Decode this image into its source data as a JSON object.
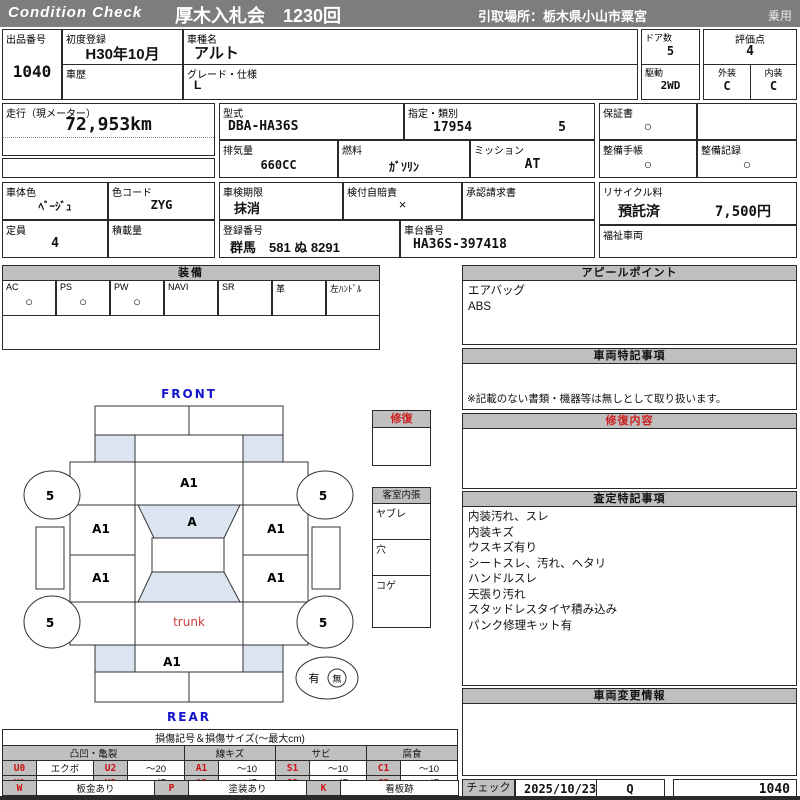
{
  "colors": {
    "header_gray": "#7d7d7d",
    "panel_gray": "#bfbfbf",
    "accent_red": "#cc2020",
    "label_blue": "#1414cc",
    "trunk_red": "#cc4040",
    "shade_blue": "#dbe4f0"
  },
  "header": {
    "brand": "Condition  Check",
    "auction_title": "厚木入札会　1230回",
    "pickup": "引取場所：栃木県小山市粟宮",
    "category": "乗用"
  },
  "fields": {
    "lot": {
      "label": "出品番号",
      "value": "1040"
    },
    "first_reg": {
      "label": "初度登録",
      "value": "H30年10月"
    },
    "history": {
      "label": "車歴",
      "value": ""
    },
    "model": {
      "label": "車種名",
      "value": "アルト"
    },
    "grade": {
      "label": "グレード・仕様",
      "value": "L"
    },
    "doors": {
      "label": "ドア数",
      "value": "5"
    },
    "drive": {
      "label": "駆動",
      "value": "2WD"
    },
    "score": {
      "label": "評価点",
      "value": "4"
    },
    "exterior": {
      "label": "外装",
      "value": "C"
    },
    "interior": {
      "label": "内装",
      "value": "C"
    },
    "mileage": {
      "label": "走行（現メーター）",
      "value": "72,953km"
    },
    "model_code": {
      "label": "型式",
      "value": "DBA-HA36S"
    },
    "type_class": {
      "label": "指定・類別",
      "value1": "17954",
      "value2": "5"
    },
    "displacement": {
      "label": "排気量",
      "value": "660CC"
    },
    "fuel": {
      "label": "燃料",
      "value": "ｶﾞｿﾘﾝ"
    },
    "transmission": {
      "label": "ミッション",
      "value": "AT"
    },
    "warranty": {
      "label": "保証書",
      "value": "○"
    },
    "service_book": {
      "label": "整備手帳",
      "value": "○"
    },
    "service_record": {
      "label": "整備記録",
      "value": "○"
    },
    "body_color": {
      "label": "車体色",
      "value": "ﾍﾞｰｼﾞｭ"
    },
    "color_code": {
      "label": "色コード",
      "value": "ZYG"
    },
    "inspection": {
      "label": "車検期限",
      "value": "抹消"
    },
    "liability_ins": {
      "label": "検付自賠責",
      "value": "×"
    },
    "approval_req": {
      "label": "承認請求書",
      "value": ""
    },
    "capacity": {
      "label": "定員",
      "value": "4"
    },
    "payload": {
      "label": "積載量",
      "value": ""
    },
    "reg_number": {
      "label": "登録番号",
      "value": "群馬　581 ぬ 8291"
    },
    "chassis_number": {
      "label": "車台番号",
      "value": "HA36S-397418"
    },
    "recycle": {
      "label": "リサイクル料",
      "status": "預託済",
      "fee": "7,500円"
    },
    "welfare": {
      "label": "福祉車両",
      "value": ""
    }
  },
  "equipment": {
    "title": "装備",
    "items": [
      {
        "label": "AC",
        "mark": "○"
      },
      {
        "label": "PS",
        "mark": "○"
      },
      {
        "label": "PW",
        "mark": "○"
      },
      {
        "label": "NAVI",
        "mark": ""
      },
      {
        "label": "SR",
        "mark": ""
      },
      {
        "label": "革",
        "mark": ""
      },
      {
        "label": "左ﾊﾝﾄﾞﾙ",
        "mark": ""
      }
    ]
  },
  "panels": {
    "appeal": {
      "title": "アピールポイント",
      "lines": [
        "エアバッグ",
        "ABS"
      ]
    },
    "special": {
      "title": "車両特記事項",
      "note": "※記載のない書類・機器等は無しとして取り扱います。"
    },
    "repair": {
      "title": "修復内容"
    },
    "assessment": {
      "title": "査定特記事項",
      "lines": [
        "内装汚れ、スレ",
        "内装キズ",
        "ウスキズ有り",
        "シートスレ、汚れ、ヘタリ",
        "ハンドルスレ",
        "天張り汚れ",
        "スタッドレスタイヤ積み込み",
        "パンク修理キット有"
      ]
    },
    "change": {
      "title": "車両変更情報"
    }
  },
  "diagram": {
    "front": "FRONT",
    "rear": "REAR",
    "trunk": "trunk",
    "marks": {
      "hood": "A1",
      "windshield": "A",
      "front_left": "A1",
      "front_right": "A1",
      "rear_left": "A1",
      "rear_right": "A1",
      "rear_panel": "A1"
    },
    "tires": {
      "front_left": "5",
      "front_right": "5",
      "rear_left": "5",
      "rear_right": "5"
    },
    "repair_box_title": "修復",
    "cabin_box": {
      "title": "客室内張",
      "rows": [
        "ヤブレ",
        "穴",
        "コゲ"
      ]
    },
    "presence": {
      "yes": "有",
      "no": "無"
    }
  },
  "legend": {
    "title": "損傷記号＆損傷サイズ(～最大cm)",
    "groups": [
      "凸凹・亀裂",
      "線キズ",
      "サビ",
      "腐食"
    ],
    "row1": [
      {
        "code": "U0",
        "val": "エクボ"
      },
      {
        "code": "U2",
        "val": "～20"
      },
      {
        "code": "A1",
        "val": "～10"
      },
      {
        "code": "S1",
        "val": "～10"
      },
      {
        "code": "C1",
        "val": "～10"
      }
    ],
    "row2": [
      {
        "code": "U1",
        "val": "～10"
      },
      {
        "code": "U3",
        "val": "20超"
      },
      {
        "code": "A2",
        "val": "10超"
      },
      {
        "code": "S2",
        "val": "10超"
      },
      {
        "code": "C2",
        "val": "10超"
      }
    ],
    "row3": [
      {
        "code": "W",
        "val": "板金あり"
      },
      {
        "code": "P",
        "val": "塗装あり"
      },
      {
        "code": "K",
        "val": "看板跡"
      }
    ],
    "row4": [
      {
        "code": "X",
        "val": "交換跡"
      },
      {
        "code": "G",
        "val": "ガラス交換要す"
      },
      {
        "code": "L",
        "val": "レンズ割れ"
      }
    ]
  },
  "footer": {
    "check_label": "チェック",
    "date": "2025/10/23",
    "checker": "Q",
    "lot": "1040"
  }
}
